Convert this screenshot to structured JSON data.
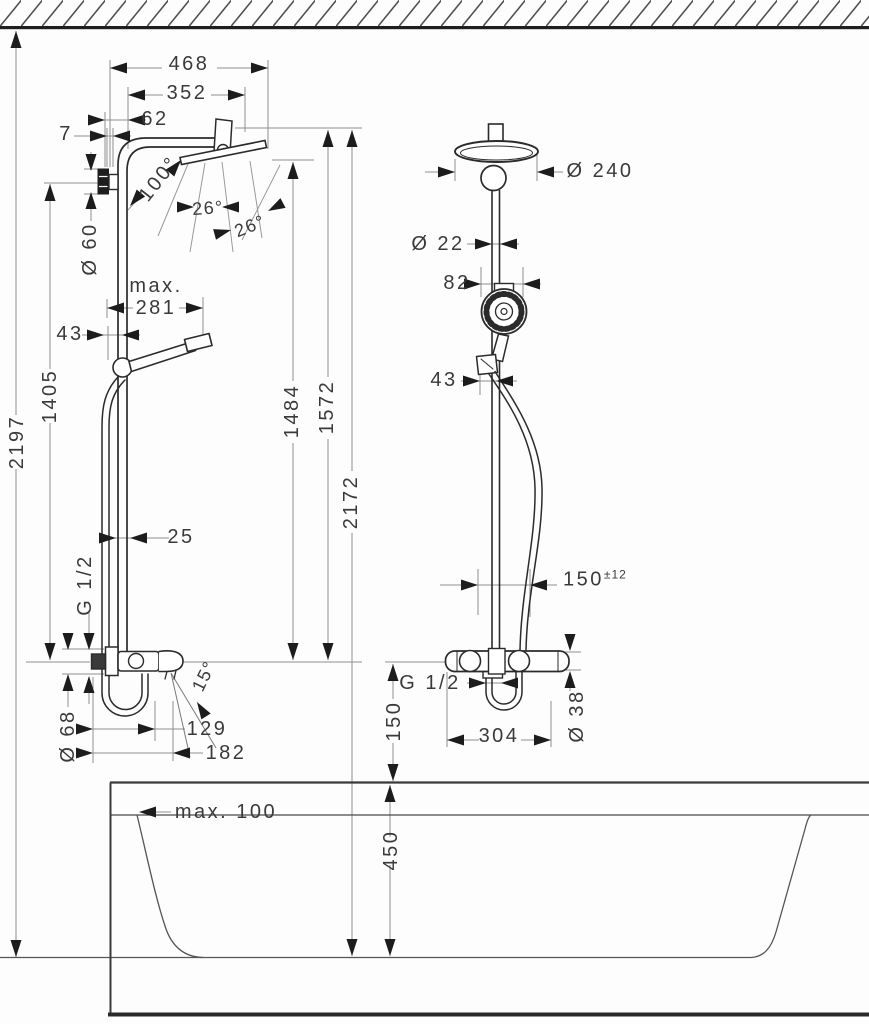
{
  "side_view": {
    "width_total": "468",
    "width_head": "352",
    "offset_head": "62",
    "wall_gap": "7",
    "spray_angle": "100°",
    "spray_angle_left": "26°",
    "spray_angle_right": "26°",
    "escutcheon_dia": "Ø 60",
    "slider_max_prefix": "max.",
    "slider_max_value": "281",
    "slider_offset": "43",
    "bracket_height": "1405",
    "total_height": "2197",
    "pipe_depth": "25",
    "thread": "G 1/2",
    "handshower_height": "1484",
    "pipe_top_height": "1572",
    "overall_height": "2172",
    "spout_angle": "15°",
    "spout_dia": "Ø 68",
    "spout_len_inner": "129",
    "spout_len_outer": "182"
  },
  "front_view": {
    "head_dia": "Ø 240",
    "pipe_dia": "Ø 22",
    "handshower_dia": "82",
    "holder_offset": "43",
    "hose_projection": "150",
    "hose_projection_tol": "±12",
    "thread": "G 1/2",
    "valve_height_above_rim": "150",
    "valve_centers": "304",
    "escutcheon_dia": "Ø 38"
  },
  "bathtub": {
    "rim_clearance": "max. 100",
    "depth": "450"
  }
}
